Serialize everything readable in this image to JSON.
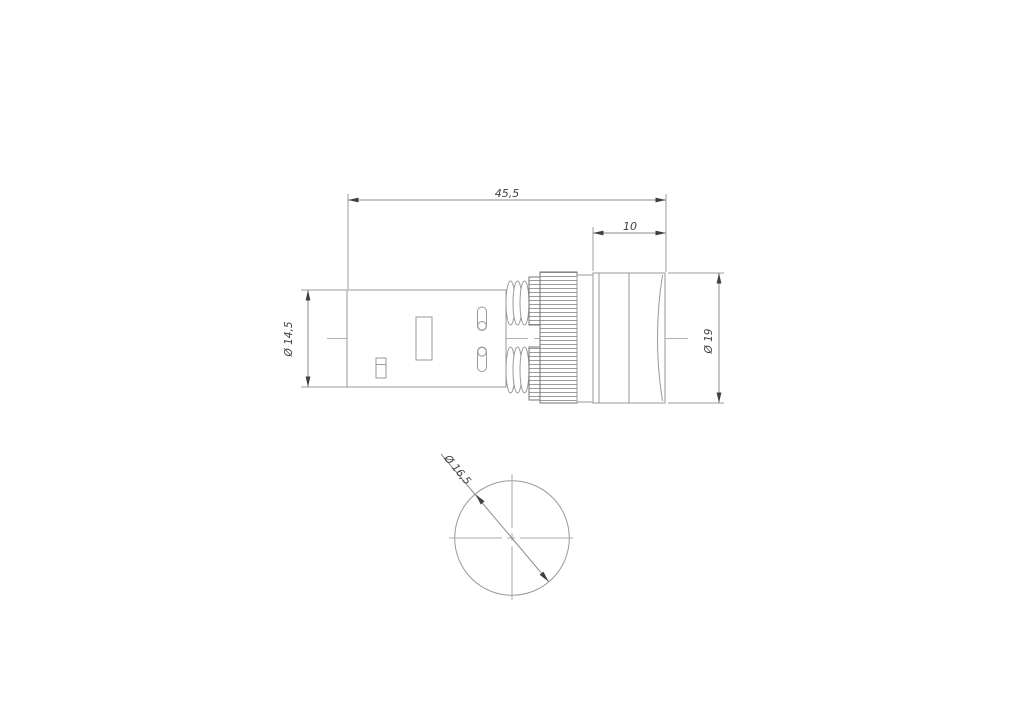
{
  "dimensions": {
    "total_length": "45,5",
    "front_section_length": "10",
    "body_diameter": "Ø 14,5",
    "front_diameter": "Ø 19",
    "lens_diameter": "Ø 16,5"
  },
  "colors": {
    "background": "#ffffff",
    "outline": "#9a9a9a",
    "knurl_edge": "#757575",
    "dimension_line": "#8c8c8c",
    "centerline": "#b2b2b2",
    "annotation": "#3f3f3f"
  }
}
